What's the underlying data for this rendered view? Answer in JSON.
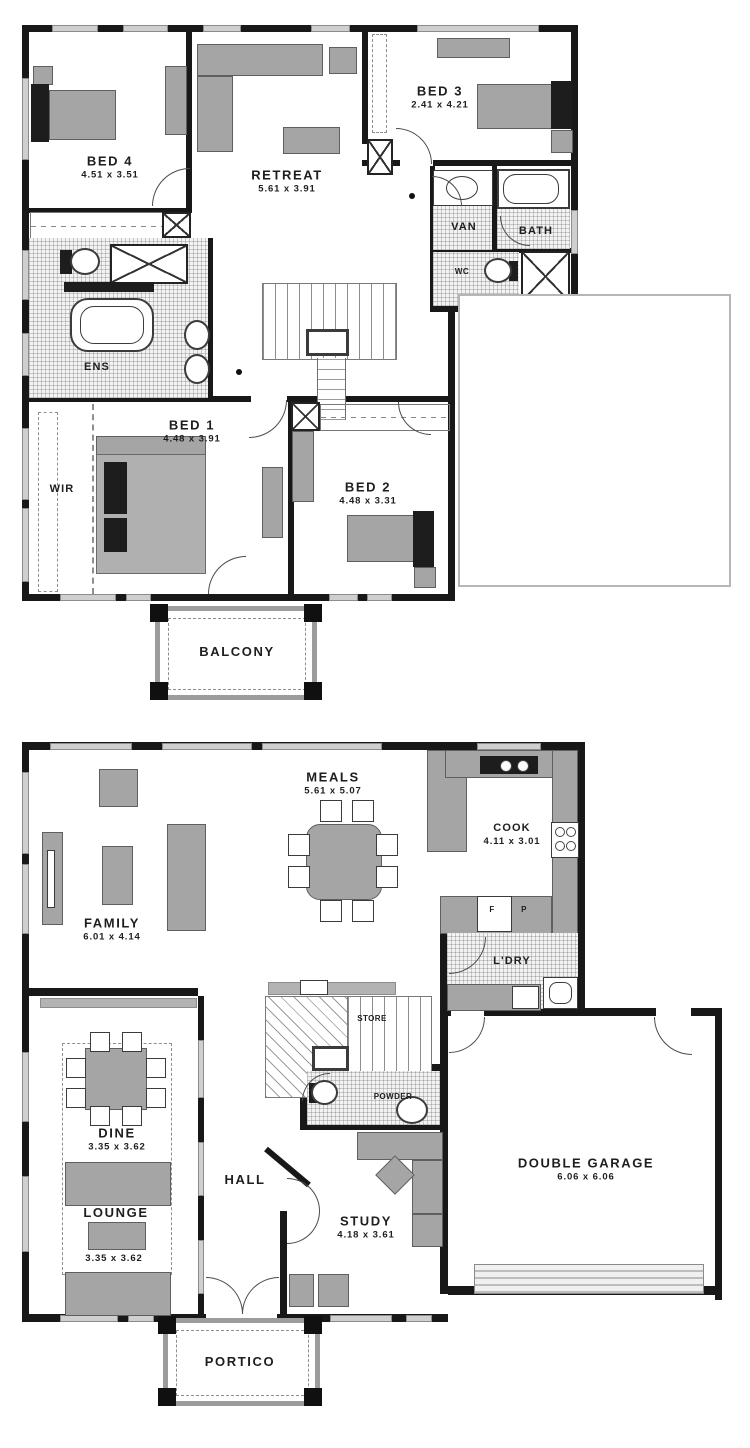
{
  "upper": {
    "bed4": {
      "label": "BED 4",
      "dims": "4.51  x  3.51"
    },
    "retreat": {
      "label": "RETREAT",
      "dims": "5.61  x  3.91"
    },
    "bed3": {
      "label": "BED 3",
      "dims": "2.41  x  4.21"
    },
    "van": {
      "label": "VAN"
    },
    "bath": {
      "label": "BATH"
    },
    "wc": {
      "label": "WC"
    },
    "ens": {
      "label": "ENS"
    },
    "wir": {
      "label": "WIR"
    },
    "bed1": {
      "label": "BED 1",
      "dims": "4.48  x  3.91"
    },
    "bed2": {
      "label": "BED 2",
      "dims": "4.48  x  3.31"
    },
    "balcony": {
      "label": "BALCONY"
    }
  },
  "ground": {
    "family": {
      "label": "FAMILY",
      "dims": "6.01  x  4.14"
    },
    "meals": {
      "label": "MEALS",
      "dims": "5.61  x  5.07"
    },
    "cook": {
      "label": "COOK",
      "dims": "4.11  x  3.01"
    },
    "fridge": {
      "label": "F"
    },
    "pantry": {
      "label": "P"
    },
    "laundry": {
      "label": "L'DRY"
    },
    "store": {
      "label": "STORE"
    },
    "powder": {
      "label": "POWDER"
    },
    "dine": {
      "label": "DINE",
      "dims": "3.35  x  3.62"
    },
    "lounge": {
      "label": "LOUNGE",
      "dims": "3.35  x  3.62"
    },
    "hall": {
      "label": "HALL"
    },
    "study": {
      "label": "STUDY",
      "dims": "4.18  x  3.61"
    },
    "garage": {
      "label": "DOUBLE GARAGE",
      "dims": "6.06  x  6.06"
    },
    "portico": {
      "label": "PORTICO"
    }
  },
  "colors": {
    "wall": "#181818",
    "furniture": "#a5a5a5",
    "window": "#cfcfcf",
    "paper": "#ffffff"
  }
}
